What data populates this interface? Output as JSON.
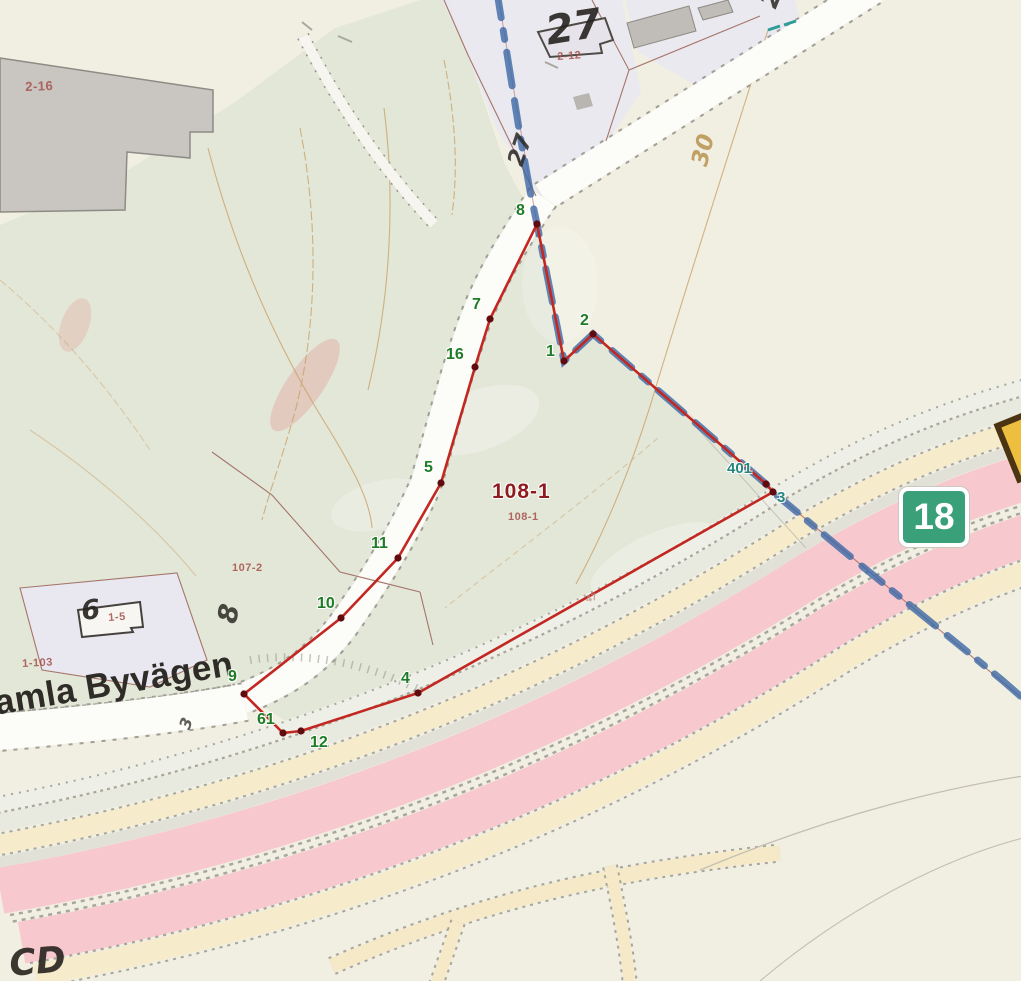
{
  "map": {
    "type_note": "cadastral map view",
    "road_badge": {
      "number": "18",
      "fill": "#3aa079",
      "left": 899,
      "top": 487,
      "width": 70,
      "height": 60
    },
    "yellow_badge_partial": {
      "left": 1004,
      "top": 414,
      "width": 30,
      "height": 52
    },
    "colors": {
      "parcel_boundary": "#c22722",
      "vertex_dot": "#600b0e",
      "municipal_boundary": "#3c68a6",
      "badge_green": "#3aa079"
    },
    "labels": [
      {
        "text": "2-16",
        "x": 25,
        "y": 80,
        "rot": -2,
        "size": 13,
        "cls": "red-sm",
        "name": "parcel-label-2-16"
      },
      {
        "text": "27",
        "x": 543,
        "y": 12,
        "rot": -9,
        "size": 40,
        "cls": "blk-xl",
        "name": "parcel-label-27"
      },
      {
        "text": "2-12",
        "x": 557,
        "y": 52,
        "rot": -4,
        "size": 11,
        "cls": "red-sm",
        "name": "parcel-label-2-12"
      },
      {
        "text": "21",
        "x": 756,
        "y": 2,
        "rot": -68,
        "size": 26,
        "cls": "blk-lg",
        "name": "label-21-top-right"
      },
      {
        "text": "27",
        "x": 505,
        "y": 162,
        "rot": -72,
        "size": 23,
        "cls": "blk-lg",
        "name": "label-27-rotated"
      },
      {
        "text": "30",
        "x": 689,
        "y": 163,
        "rot": -76,
        "size": 23,
        "cls": "tan-lg",
        "name": "contour-label-30"
      },
      {
        "text": "108-1",
        "x": 492,
        "y": 481,
        "rot": 0,
        "size": 21,
        "cls": "darkred-lg halo",
        "name": "parcel-label-108-1"
      },
      {
        "text": "108-1",
        "x": 508,
        "y": 512,
        "rot": 0,
        "size": 11,
        "cls": "red-sm",
        "name": "parcel-sublabel-108-1"
      },
      {
        "text": "107-2",
        "x": 232,
        "y": 563,
        "rot": 0,
        "size": 11,
        "cls": "red-sm",
        "name": "parcel-label-107-2"
      },
      {
        "text": "1-103",
        "x": 22,
        "y": 659,
        "rot": -3,
        "size": 11,
        "cls": "red-sm",
        "name": "parcel-label-1-103"
      },
      {
        "text": "6",
        "x": 80,
        "y": 598,
        "rot": -6,
        "size": 27,
        "cls": "blk-xl",
        "name": "house-number-6"
      },
      {
        "text": "1-5",
        "x": 108,
        "y": 613,
        "rot": -4,
        "size": 11,
        "cls": "red-sm",
        "name": "parcel-label-1-5"
      },
      {
        "text": "8",
        "x": 214,
        "y": 620,
        "rot": -78,
        "size": 27,
        "cls": "blk-lg",
        "name": "label-8-rotated"
      },
      {
        "text": "amla Byvägen",
        "x": -8,
        "y": 686,
        "rot": -9.5,
        "size": 35,
        "cls": "roadname",
        "name": "road-name-gamla-byvagen"
      },
      {
        "text": "3",
        "x": 177,
        "y": 726,
        "rot": -70,
        "size": 16,
        "cls": "blk-sm",
        "name": "label-3-small-rotated"
      },
      {
        "text": "47",
        "x": 585,
        "y": 596,
        "rot": -18,
        "size": 10,
        "cls": "faint-sm",
        "name": "label-47-faint"
      },
      {
        "text": "CD",
        "x": 8,
        "y": 947,
        "rot": -5,
        "size": 36,
        "cls": "blk-xl",
        "name": "label-bottom-left-partial"
      }
    ],
    "parcel_boundary": {
      "id": "108-1",
      "vertices": [
        {
          "n": "8",
          "x": 537,
          "y": 224,
          "lx": 516,
          "ly": 203
        },
        {
          "n": "1",
          "x": 564,
          "y": 361,
          "lx": 546,
          "ly": 344
        },
        {
          "n": "2",
          "x": 593,
          "y": 334,
          "lx": 580,
          "ly": 313
        },
        {
          "n": "401",
          "x": 766,
          "y": 484,
          "lx": 727,
          "ly": 461,
          "teal": true
        },
        {
          "n": "3",
          "x": 773,
          "y": 492,
          "lx": 777,
          "ly": 490,
          "teal": true
        },
        {
          "n": "4",
          "x": 418,
          "y": 693,
          "lx": 401,
          "ly": 671
        },
        {
          "n": "12",
          "x": 301,
          "y": 731,
          "lx": 310,
          "ly": 735
        },
        {
          "n": "61",
          "x": 283,
          "y": 733,
          "lx": 257,
          "ly": 712
        },
        {
          "n": "9",
          "x": 244,
          "y": 694,
          "lx": 228,
          "ly": 669
        },
        {
          "n": "10",
          "x": 341,
          "y": 618,
          "lx": 317,
          "ly": 596
        },
        {
          "n": "11",
          "x": 398,
          "y": 558,
          "lx": 371,
          "ly": 536
        },
        {
          "n": "5",
          "x": 441,
          "y": 483,
          "lx": 424,
          "ly": 460
        },
        {
          "n": "16",
          "x": 475,
          "y": 367,
          "lx": 446,
          "ly": 347
        },
        {
          "n": "7",
          "x": 490,
          "y": 319,
          "lx": 472,
          "ly": 297
        }
      ]
    },
    "municipal_boundary": {
      "points": [
        [
          497,
          -8
        ],
        [
          508,
          60
        ],
        [
          520,
          135
        ],
        [
          531,
          196
        ],
        [
          537,
          224
        ],
        [
          564,
          361
        ],
        [
          593,
          334
        ],
        [
          766,
          484
        ],
        [
          773,
          492
        ],
        [
          846,
          553
        ],
        [
          916,
          610
        ],
        [
          1002,
          680
        ],
        [
          1034,
          708
        ]
      ]
    }
  }
}
